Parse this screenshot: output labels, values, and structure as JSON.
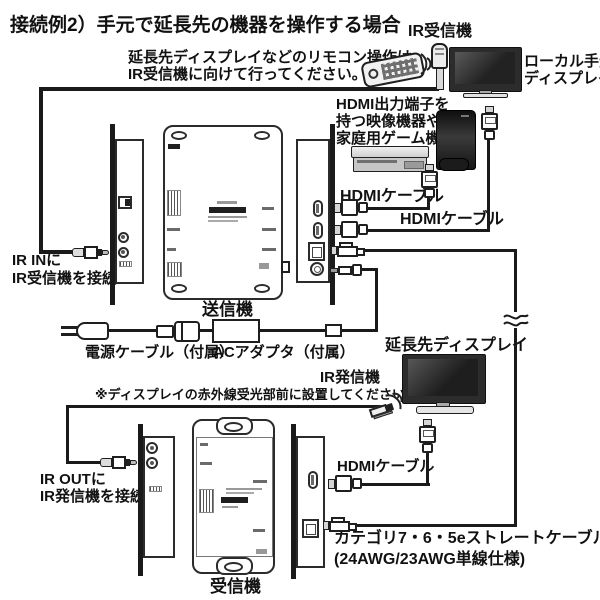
{
  "page": {
    "background": "#ffffff",
    "line_color": "#1a1a1a"
  },
  "title": "接続例2）手元で延長先の機器を操作する場合",
  "top": {
    "remote_note_1": "延長先ディスプレイなどのリモコン操作は",
    "remote_note_2": "IR受信機に向けて行ってください。",
    "ir_receiver": "IR受信機",
    "local_display_1": "ローカル手元",
    "local_display_2": "ディスプレイ",
    "source_1": "HDMI出力端子を",
    "source_2": "持つ映像機器や",
    "source_3": "家庭用ゲーム機",
    "hdmi_cable_a": "HDMIケーブル",
    "hdmi_cable_b": "HDMIケーブル",
    "ir_in_1": "IR INに",
    "ir_in_2": "IR受信機を接続",
    "transmitter": "送信機",
    "power_cable": "電源ケーブル（付属）",
    "ac_adapter": "ACアダプタ（付属）"
  },
  "bottom": {
    "extended_display": "延長先ディスプレイ",
    "ir_emitter": "IR発信機",
    "ir_emitter_note": "※ディスプレイの赤外線受光部前に設置してください。",
    "ir_out_1": "IR OUTに",
    "ir_out_2": "IR発信機を接続",
    "hdmi_cable_c": "HDMIケーブル",
    "cat_cable_1": "カテゴリ7・6・5eストレートケーブル",
    "cat_cable_2": "(24AWG/23AWG単線仕様)",
    "receiver": "受信機"
  }
}
